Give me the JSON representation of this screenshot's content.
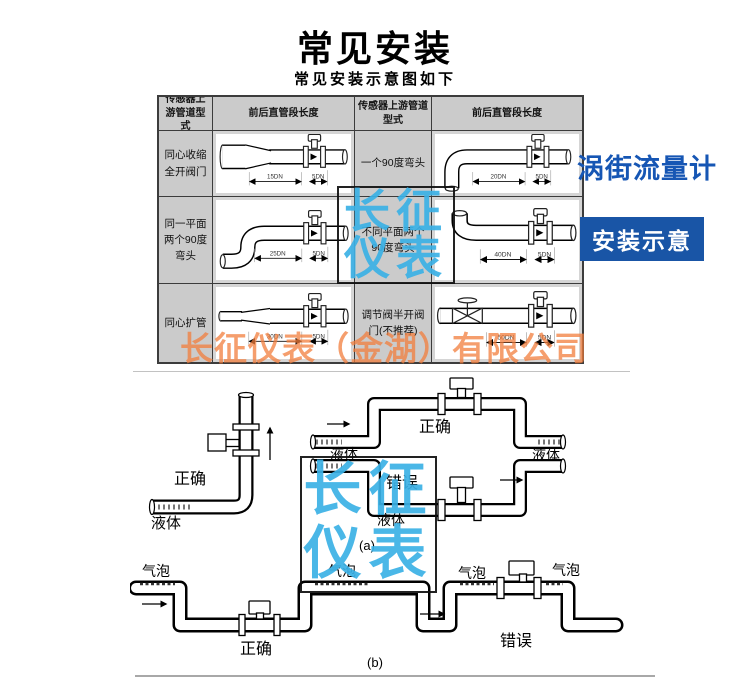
{
  "title": "常见安装",
  "subtitle": "常见安装示意图如下",
  "side": {
    "product_title": "涡街流量计",
    "badge": "安装示意"
  },
  "watermarks": {
    "brand_line1": "长征",
    "brand_line2": "仪表",
    "company": "长征仪表（金湖）有限公司",
    "brand_color": "#3BB1E6",
    "company_color": "#F27D3C"
  },
  "colors": {
    "product_blue": "#1656B4",
    "badge_bg": "#1955A6",
    "table_gray": "#CBCBCB"
  },
  "table": {
    "headers": [
      "传感器上游管道型式",
      "前后直管段长度",
      "传感器上游管道型式",
      "前后直管段长度"
    ],
    "rows": [
      {
        "left": {
          "label": "同心收缩全开阀门",
          "dims": [
            "15DN",
            "5DN"
          ]
        },
        "right": {
          "label": "一个90度弯头",
          "dims": [
            "20DN",
            "5DN"
          ]
        }
      },
      {
        "left": {
          "label": "同一平面两个90度弯头",
          "dims": [
            "25DN",
            "5DN"
          ]
        },
        "right": {
          "label": "不同平面两个90度弯头",
          "dims": [
            "40DN",
            "5DN"
          ]
        }
      },
      {
        "left": {
          "label": "同心扩管",
          "dims": [
            "30DN",
            "5DN"
          ]
        },
        "right": {
          "label": "调节阀半开阀门(不推荐)",
          "dims": [
            "50DN",
            "5DN"
          ]
        }
      }
    ]
  },
  "figure_a": {
    "correct_left": "正确",
    "liquid_left": "液体",
    "liquid_mid_left": "液体",
    "correct_top": "正确",
    "liquid_mid_right": "液体",
    "wrong": "错误",
    "liquid_bottom": "液体",
    "caption": "(a)"
  },
  "figure_b": {
    "bubble_1": "气泡",
    "bubble_2": "气泡",
    "bubble_3": "气泡",
    "bubble_4": "气泡",
    "correct": "正确",
    "wrong": "错误",
    "caption": "(b)"
  }
}
